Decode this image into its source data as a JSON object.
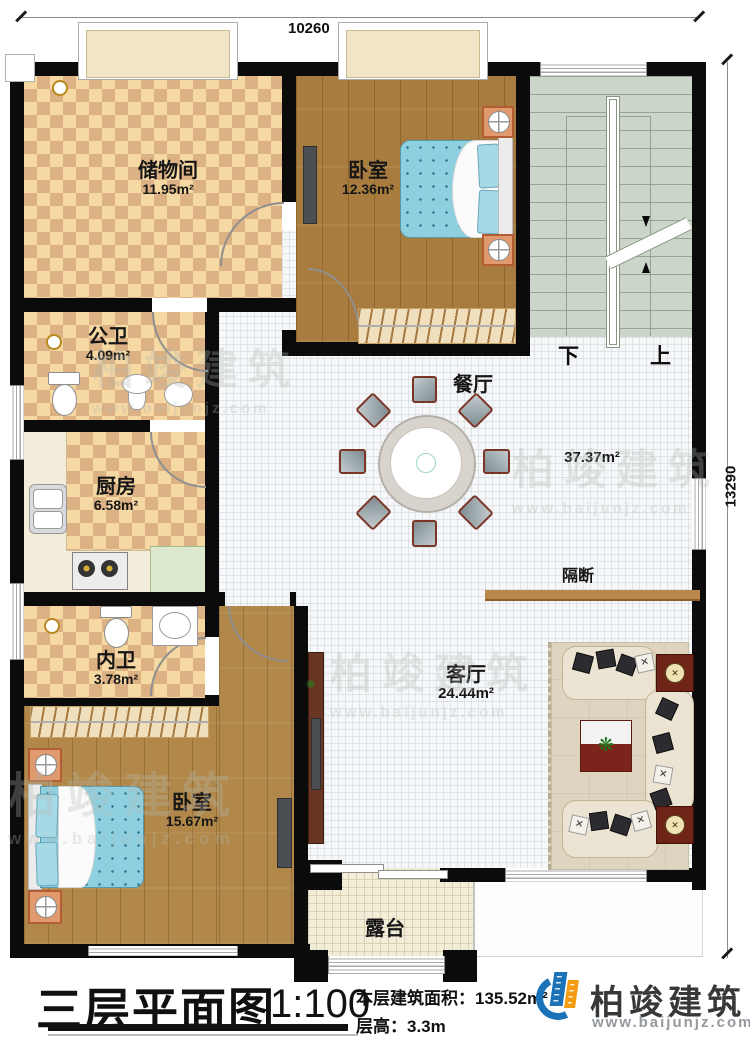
{
  "plan": {
    "dims": {
      "width": "10260",
      "height": "13290"
    },
    "rooms": {
      "storage": {
        "name": "储物间",
        "area": "11.95m²"
      },
      "bedroom_top": {
        "name": "卧室",
        "area": "12.36m²"
      },
      "public_bath": {
        "name": "公卫",
        "area": "4.09m²"
      },
      "kitchen": {
        "name": "厨房",
        "area": "6.58m²"
      },
      "dining": {
        "name": "餐厅"
      },
      "hall": {
        "area": "37.37m²"
      },
      "partition": {
        "name": "隔断"
      },
      "inner_bath": {
        "name": "内卫",
        "area": "3.78m²"
      },
      "bedroom_bottom": {
        "name": "卧室",
        "area": "15.67m²"
      },
      "living": {
        "name": "客厅",
        "area": "24.44m²"
      },
      "terrace": {
        "name": "露台"
      }
    },
    "stairs": {
      "down": "下",
      "up": "上"
    }
  },
  "footer": {
    "title": "三层平面图",
    "scale": "1:100",
    "area_label": "本层建筑面积：135.52m²",
    "height_label": "层高：3.3m",
    "brand": "柏竣建筑",
    "website": "www.baijunjz.com"
  },
  "watermark": {
    "brand": "柏竣建筑",
    "url": "www.baijunjz.com"
  },
  "icons": {
    "plant": "❋",
    "cross": "✕"
  },
  "colors": {
    "brand_blue": "#1a72b8",
    "brand_orange": "#f39c12",
    "checker_dark": "#dcb183",
    "checker_light": "#f6d8a2",
    "wood": "#a87c3e"
  }
}
